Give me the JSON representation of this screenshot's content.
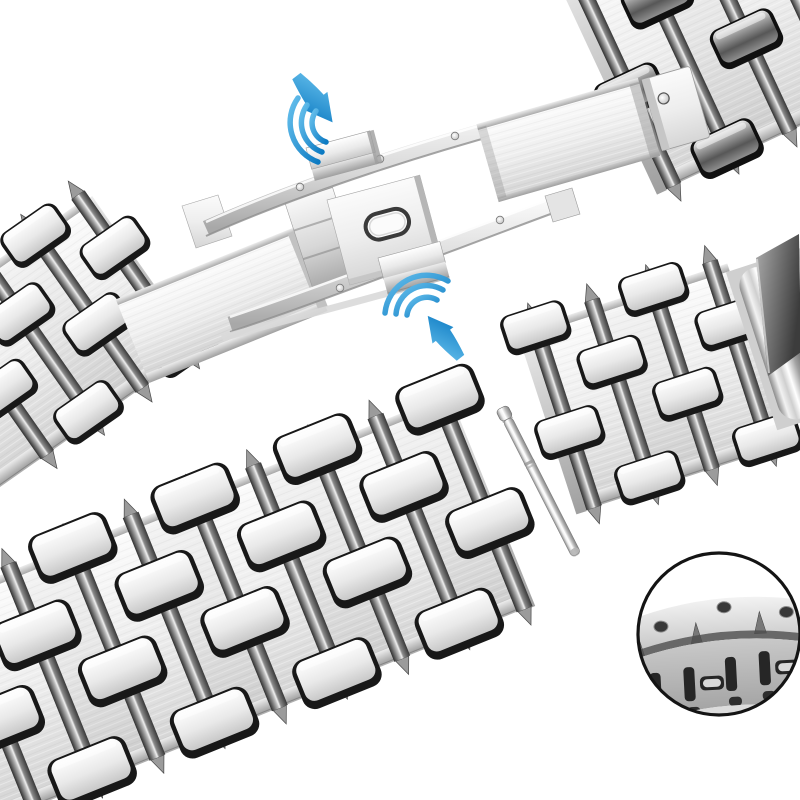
{
  "meta": {
    "description": "Disassembled silver stainless steel watch bracelet: butterfly deployment clasp with push buttons marked by blue press arrows, detached link sections, a spring bar pin, and a circular magnified detail of the link edge"
  },
  "colors": {
    "background": "#ffffff",
    "arrow_blue_light": "#65bfec",
    "arrow_blue_dark": "#0c7ac2",
    "magnifier_ring": "#141414"
  },
  "scene": {
    "bands": [
      {
        "id": "band-top-right",
        "translate": [
          563,
          -33
        ],
        "rotate": -25,
        "length": 330,
        "across": 230,
        "colW": 64,
        "grooveStart": 8,
        "tabStyle": "dark",
        "tabScale": 0.82,
        "endLeft": true,
        "endRight": false
      },
      {
        "id": "band-left",
        "translate": [
          -110,
          345
        ],
        "rotate": -35,
        "length": 240,
        "across": 165,
        "colW": 58,
        "grooveStart": 66,
        "tabStyle": "light",
        "tabScale": 0.8,
        "endLeft": false,
        "endRight": true
      },
      {
        "id": "band-big",
        "translate": [
          -77,
          615
        ],
        "rotate": -22,
        "length": 560,
        "across": 205,
        "colW": 66,
        "grooveStart": 32,
        "tabStyle": "light",
        "tabScale": 1,
        "endLeft": false,
        "endRight": true
      },
      {
        "id": "band-right",
        "translate": [
          530,
          336
        ],
        "rotate": -18,
        "length": 208,
        "across": 168,
        "colW": 62,
        "grooveStart": 8,
        "tabStyle": "light",
        "tabScale": 0.8,
        "endLeft": true,
        "endRight": false
      }
    ],
    "parts": [
      {
        "name": "butterfly-clasp",
        "desc": "deployment clasp with curved arms, center plate with oval slot, two push buttons"
      },
      {
        "name": "press-arrow-top",
        "desc": "blue arrow pointing at upper push button"
      },
      {
        "name": "press-arrow-bottom",
        "desc": "blue arrow pointing at lower push button"
      },
      {
        "name": "spring-bar-pin",
        "desc": "removable link pin"
      },
      {
        "name": "magnified-detail",
        "desc": "circular zoom of bracelet edge with screw holes"
      }
    ]
  }
}
